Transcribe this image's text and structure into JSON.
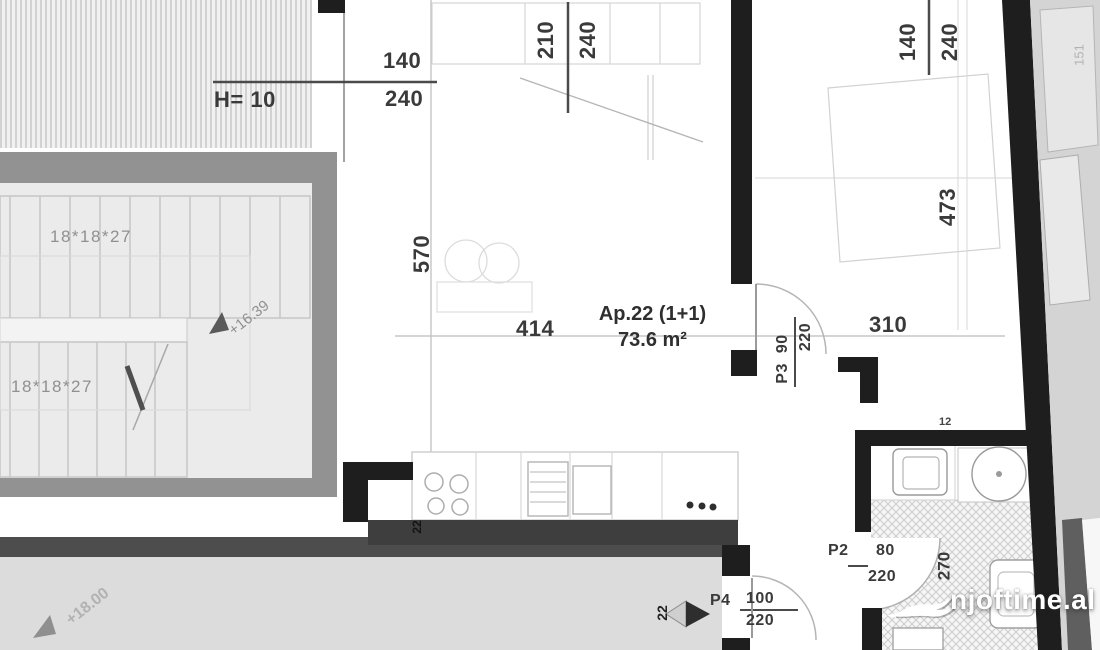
{
  "apartment": {
    "label": "Ap.22 (1+1)",
    "area": "73.6 m²",
    "unit_number": "22"
  },
  "dimensions": {
    "height_note": "H= 10",
    "window_left_num": "140",
    "window_left_den": "240",
    "window_mid_num": "210",
    "window_mid_den": "240",
    "window_right_num": "140",
    "window_right_den": "240",
    "living_width": "414",
    "living_depth": "570",
    "hall_width": "310",
    "bedroom_depth": "473",
    "bath_depth": "270",
    "wall_tick": "12",
    "facade_side": "151",
    "wall_note": "22"
  },
  "doors": {
    "p3_code": "P3",
    "p3_size": "90",
    "p3_height": "220",
    "p2_code": "P2",
    "p2_size": "80",
    "p2_height": "220",
    "p4_code": "P4",
    "p4_size": "100",
    "p4_height": "220"
  },
  "stairs": {
    "riser_label_upper": "18*18*27",
    "riser_label_lower": "18*18*27",
    "level_upper": "+16.39",
    "level_lower": "+18.00"
  },
  "watermark": {
    "site": "njoftime.al"
  }
}
